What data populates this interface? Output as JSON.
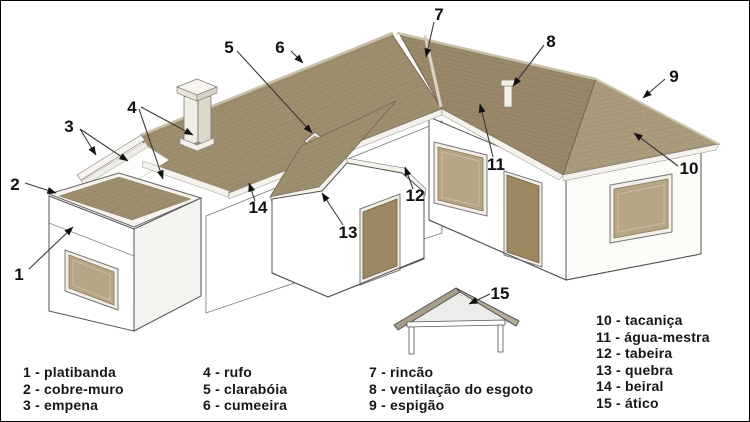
{
  "title": "Partes do telhado (roof parts diagram)",
  "callouts": {
    "numbers": [
      "1",
      "2",
      "3",
      "4",
      "5",
      "6",
      "7",
      "8",
      "9",
      "10",
      "11",
      "12",
      "13",
      "14",
      "15"
    ]
  },
  "legend": {
    "columns": [
      {
        "items": [
          "1 - platibanda",
          "2 - cobre-muro",
          "3 - empena"
        ]
      },
      {
        "items": [
          "4 - rufo",
          "5 - clarabóia",
          "6 - cumeeira"
        ]
      },
      {
        "items": [
          "7 - rincão",
          "8 - ventilação do esgoto",
          "9 - espigão"
        ]
      },
      {
        "items": [
          "10 - tacaniça",
          "11 - água-mestra",
          "12 - tabeira",
          "13 - quebra",
          "14 - beiral",
          "15 - ático"
        ]
      }
    ]
  },
  "colors": {
    "roof_shingle": "#9e8f6f",
    "roof_shingle_dark": "#877857",
    "wood_panel": "#b6a685",
    "door": "#9c8962",
    "wall": "#ffffff",
    "trim": "#f4f2ea",
    "outline": "#555555",
    "label_text": "#111111",
    "background": "#ffffff",
    "border": "#000000"
  }
}
